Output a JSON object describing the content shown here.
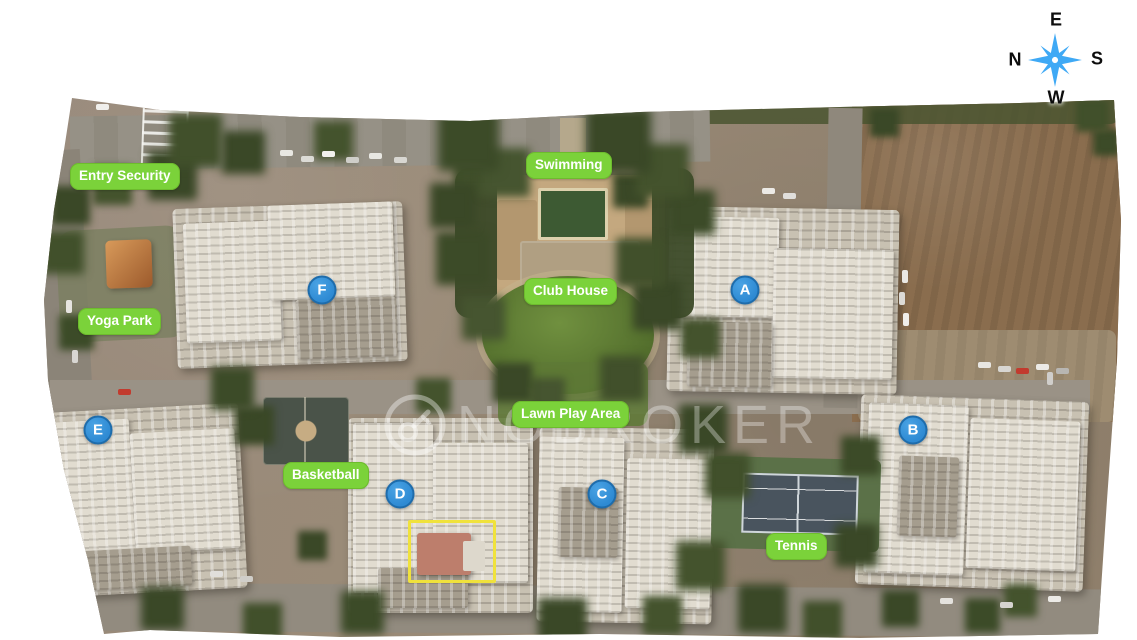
{
  "watermark": {
    "text": "NOBROKER"
  },
  "compass": {
    "top": "E",
    "right": "S",
    "bottom": "W",
    "left": "N"
  },
  "amenity_labels": [
    {
      "id": "entry-security",
      "text": "Entry Security",
      "x": 70,
      "y": 163
    },
    {
      "id": "yoga-park",
      "text": "Yoga Park",
      "x": 78,
      "y": 308
    },
    {
      "id": "swimming",
      "text": "Swimming",
      "x": 526,
      "y": 152
    },
    {
      "id": "club-house",
      "text": "Club House",
      "x": 524,
      "y": 278
    },
    {
      "id": "lawn-play-area",
      "text": "Lawn Play Area",
      "x": 512,
      "y": 401
    },
    {
      "id": "basketball",
      "text": "Basketball",
      "x": 283,
      "y": 462
    },
    {
      "id": "tennis",
      "text": "Tennis",
      "x": 766,
      "y": 533
    }
  ],
  "building_markers": [
    {
      "letter": "A",
      "x": 745,
      "y": 290
    },
    {
      "letter": "B",
      "x": 913,
      "y": 430
    },
    {
      "letter": "C",
      "x": 602,
      "y": 494
    },
    {
      "letter": "D",
      "x": 400,
      "y": 494
    },
    {
      "letter": "E",
      "x": 98,
      "y": 430
    },
    {
      "letter": "F",
      "x": 322,
      "y": 290
    }
  ],
  "highlight_box": {
    "x": 408,
    "y": 520,
    "width": 82,
    "height": 57
  },
  "colors": {
    "label-green": "#7bd23a",
    "marker-blue": "#2e8ad3",
    "marker-border": "#1e6cab",
    "compass-blue": "#3fa9f5",
    "highlight-yellow": "#f0e23c",
    "watermark-white": "rgba(255,255,255,0.32)"
  }
}
